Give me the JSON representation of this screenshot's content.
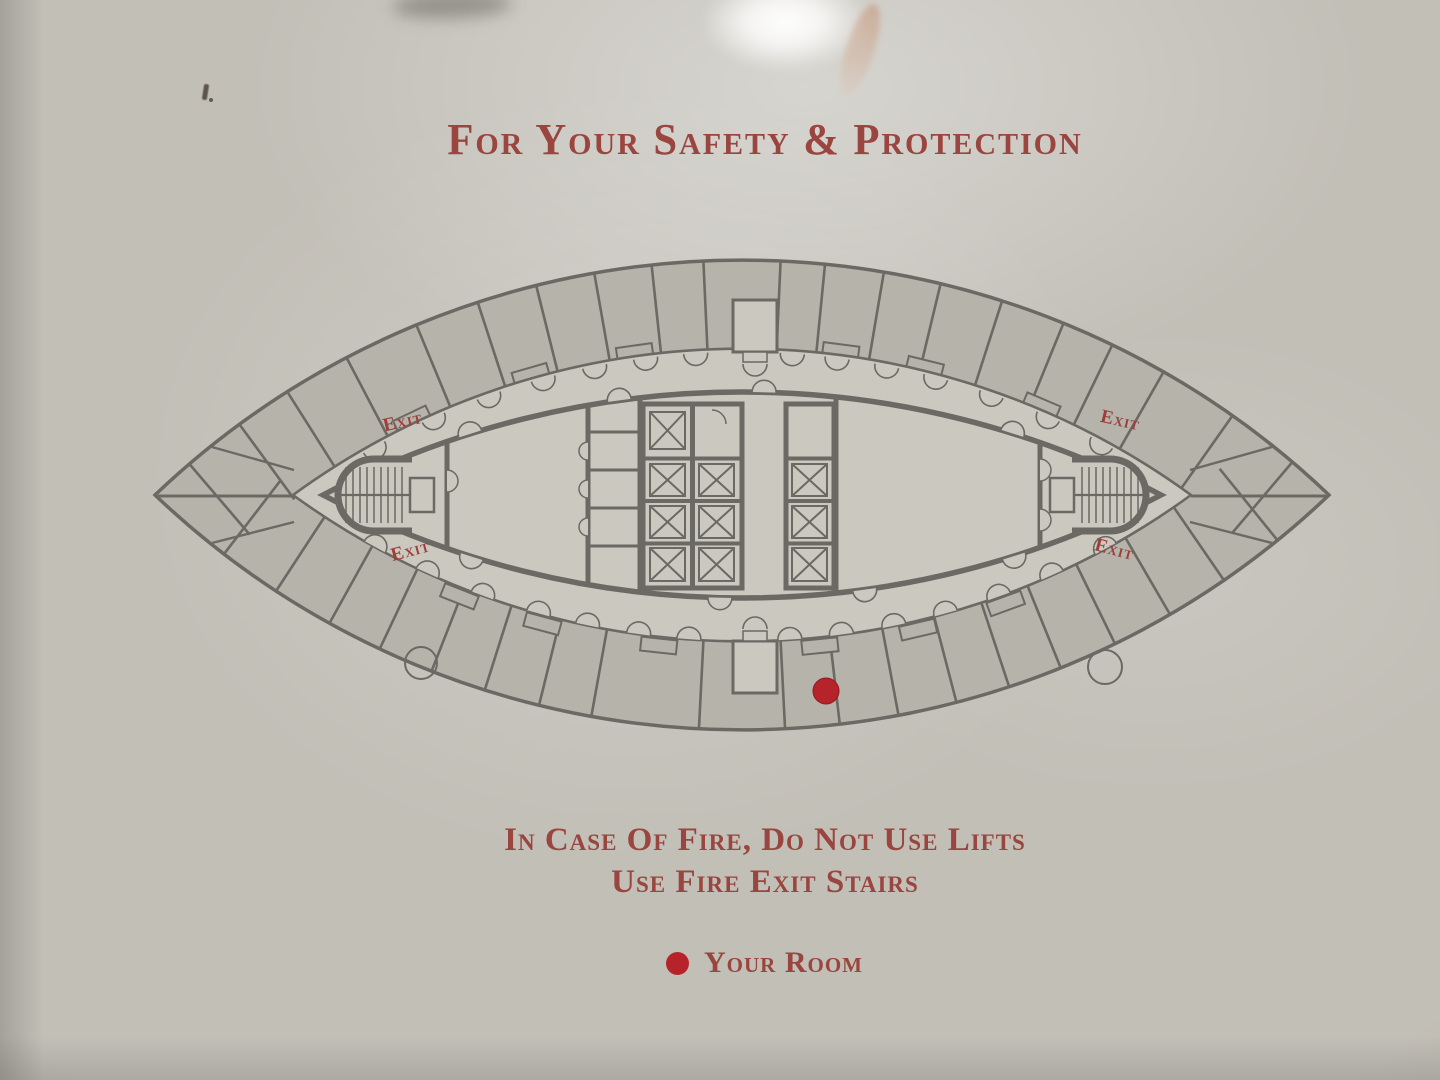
{
  "sign": {
    "title": "For Your Safety & Protection",
    "warning_line1": "In Case Of Fire, Do Not Use Lifts",
    "warning_line2": "Use Fire Exit Stairs",
    "legend_label": "Your Room",
    "exit_labels": [
      "Exit",
      "Exit",
      "Exit",
      "Exit"
    ],
    "marker": {
      "meaning": "Your Room",
      "shape": "red-dot"
    },
    "plan_summary": {
      "elevator_shafts": 10,
      "fire_stairs": 2,
      "exit_label_count": 4
    },
    "colors": {
      "text_red": "#9a453f",
      "exit_red": "#9c3f3a",
      "marker_red": "#b6232a",
      "wall_gray": "#6b6963",
      "room_fill": "#b6b3ab",
      "floor_fill": "#cbc8c0"
    }
  }
}
